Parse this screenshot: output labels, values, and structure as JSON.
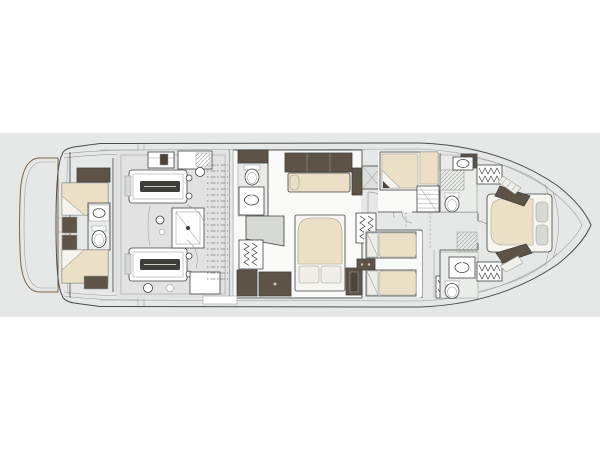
{
  "page": {
    "background": "#ffffff"
  },
  "plan": {
    "kind": "yacht-lower-deck-floorplan",
    "orientation": "bow-right",
    "colors": {
      "page_bg": "#ffffff",
      "backdrop": "#e6e8e7",
      "hull_fill": "#fdfdfc",
      "hull_outline": "#4b4b4b",
      "wall": "#424242",
      "line_soft": "#9a9e9b",
      "floor_white": "#fafaf8",
      "engine_floor": "#e1e2e1",
      "tile_gray": "#e9ece9",
      "teak": "#b28f64",
      "teak_line": "#8f7350",
      "teak_edge": "#7e6443",
      "cushion": "#ebe0c6",
      "bedding": "#f6f5ef",
      "pillow": "#efede6",
      "dark_brown": "#5d5347",
      "dark_brown2": "#4c443b",
      "fixture_gray": "#d6d9d6",
      "metal_dark": "#3e3e3a",
      "xbox_fill": "#dcdedc",
      "hatch_line": "#9aa09a",
      "tick": "#7f847f"
    },
    "areas": {
      "swim_platform": "Swim platform",
      "transom": "Transom",
      "crew_cabin": "Crew cabin",
      "crew_head": "Crew bathroom",
      "engine_room": "Engine room",
      "engine_port": "Port engine",
      "engine_starboard": "Starboard engine",
      "master_cabin": "Master cabin",
      "master_bathroom": "Master bathroom",
      "master_wardrobe": "Master wardrobe",
      "master_sofa": "Master sofa",
      "master_bed": "Master bed",
      "utility_space": "Utility space",
      "guest_cabin": "Guest cabin",
      "staircase": "Staircase",
      "corridor": "Corridor",
      "twin_cabin": "Twin guest cabin",
      "guest_bathroom_upper": "Guest bathroom",
      "guest_bathroom_lower": "Guest bathroom",
      "vip_cabin": "VIP cabin",
      "vip_bed": "VIP bed",
      "bow": "Bow",
      "hull": "Hull"
    }
  }
}
